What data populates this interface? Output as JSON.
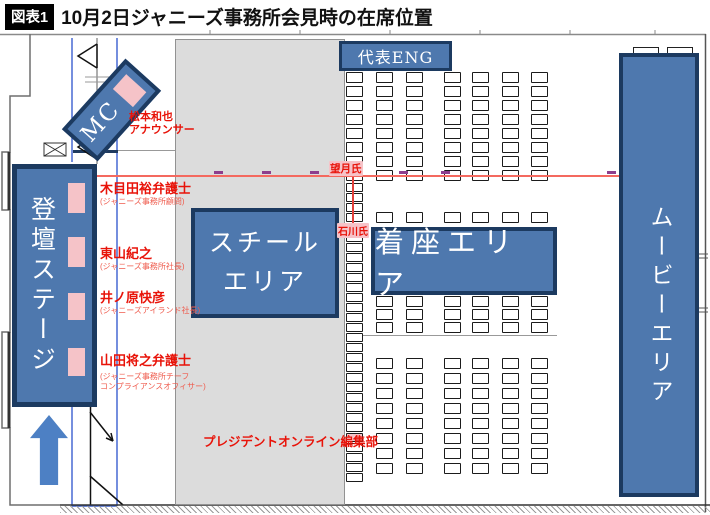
{
  "title": {
    "badge": "図表1",
    "text": "10月2日ジャニーズ事務所会見時の在席位置"
  },
  "areas": {
    "stage": {
      "label": "登壇ステージ"
    },
    "mc": {
      "label": "MC"
    },
    "steel": {
      "label_line1": "スチール",
      "label_line2": "エリア"
    },
    "eng": {
      "label": "代表ENG"
    },
    "seated": {
      "label": "着座エリア"
    },
    "movie": {
      "label": "ムービーエリア"
    }
  },
  "people": [
    {
      "name": "松本和也",
      "role": "アナウンサー"
    },
    {
      "name": "木目田裕弁護士",
      "role": "(ジャニーズ事務所顧問)"
    },
    {
      "name": "東山紀之",
      "role": "(ジャニーズ事務所社長)"
    },
    {
      "name": "井ノ原快彦",
      "role": "(ジャニーズアイランド社長)"
    },
    {
      "name": "山田将之弁護士",
      "role": "(ジャニーズ事務所チーフ",
      "role2": "コンプライアンスオフィサー)"
    }
  ],
  "markers": {
    "mochizuki": "望月氏",
    "ishikawa": "石川氏",
    "president_online": "プレジデントオンライン編集部"
  },
  "colors": {
    "area_fill": "#4e78ae",
    "area_border": "#1c3a60",
    "pink_highlight": "#f5c3c8",
    "red_label": "#e81309",
    "red_line": "#f4695f",
    "purple_dash": "#8d3e8d",
    "gray_column": "#dcdcdc",
    "arrow_blue": "#4d80c4"
  },
  "seat_layout": {
    "columns_x": [
      346,
      376,
      406,
      444,
      472,
      502,
      531
    ],
    "seat_w": 17,
    "seat_h": 11,
    "row_blocks": [
      {
        "rows_y": [
          72,
          86,
          100,
          114,
          128,
          142,
          156,
          170
        ],
        "cols": [
          0,
          1,
          2,
          3,
          4,
          5,
          6
        ]
      },
      {
        "rows_y": [
          212
        ],
        "cols": [
          1,
          2,
          3,
          4,
          5,
          6
        ]
      },
      {
        "rows_y": [
          296,
          309,
          322
        ],
        "cols": [
          1,
          2,
          3,
          4,
          5,
          6
        ]
      },
      {
        "rows_y": [
          358,
          373,
          388,
          403,
          418,
          433,
          448,
          463
        ],
        "cols": [
          1,
          2,
          3,
          4,
          5,
          6
        ]
      }
    ],
    "tight_column": {
      "x": 346,
      "y_start": 183,
      "pitch": 10,
      "count": 30,
      "seat_h": 9,
      "pink_indices": [
        4,
        25
      ]
    },
    "purple_dash_x": [
      214,
      262,
      310,
      399,
      441,
      607
    ]
  }
}
